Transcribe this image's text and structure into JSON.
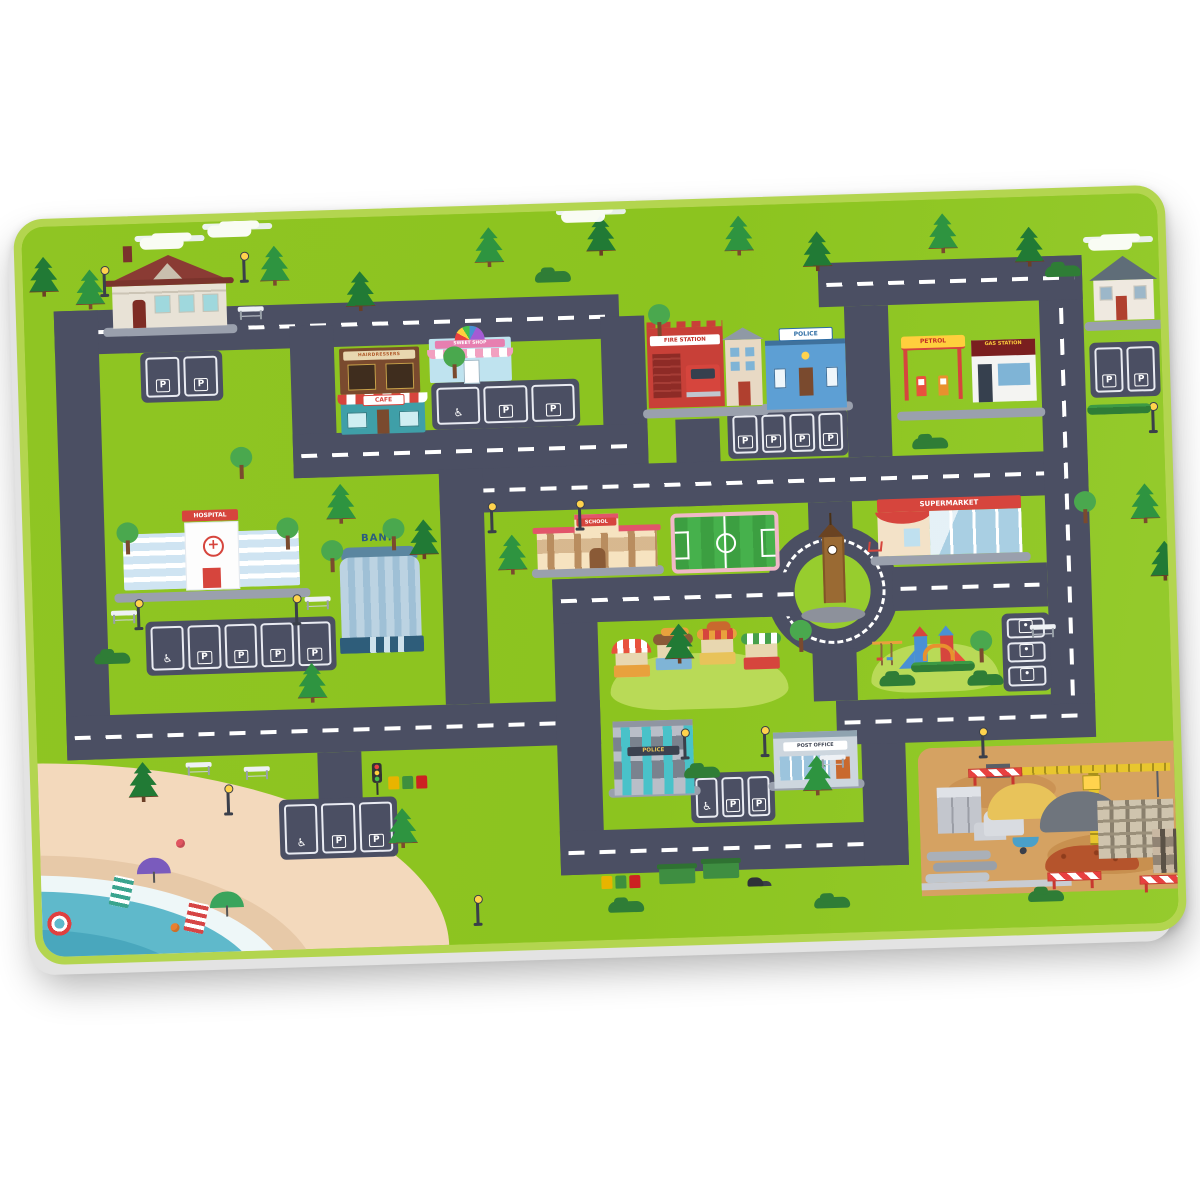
{
  "product": {
    "description": "Kids city road play mat desk pad on white background",
    "background_color": "#ffffff"
  },
  "mat": {
    "base_color": "#8cc41f",
    "rim_color": "#b3d54f",
    "road_color": "#4b4f63",
    "sand_color": "#f3d9bc",
    "water_color": "#5fb9cb",
    "construction_ground_color": "#d5a262",
    "labels": {
      "hospital": "HOSPITAL",
      "bank": "BANK",
      "school": "SCHOOL",
      "fire_station": "FIRE STATION",
      "police_station": "POLICE",
      "police_building": "POLICE",
      "post_office": "POST OFFICE",
      "supermarket": "SUPERMARKET",
      "petrol": "PETROL",
      "gas_station": "GAS STATION",
      "cafe": "CAFE",
      "hairdresser": "HAIRDRESSERS",
      "sweet_shop": "SWEET SHOP",
      "parking_letter": "P"
    },
    "roads": [
      {
        "x": 30,
        "y": 85,
        "w": 565,
        "h": 44,
        "dash": 1
      },
      {
        "x": 30,
        "y": 85,
        "w": 44,
        "h": 449
      },
      {
        "x": 265,
        "y": 107,
        "w": 44,
        "h": 152
      },
      {
        "x": 576,
        "y": 107,
        "w": 44,
        "h": 152
      },
      {
        "x": 265,
        "y": 215,
        "w": 355,
        "h": 44,
        "dash": 1
      },
      {
        "x": 648,
        "y": 212,
        "w": 44,
        "h": 87
      },
      {
        "x": 410,
        "y": 255,
        "w": 649,
        "h": 44,
        "dash": 1
      },
      {
        "x": 410,
        "y": 255,
        "w": 44,
        "h": 235
      },
      {
        "x": 30,
        "y": 490,
        "w": 534,
        "h": 44,
        "dash": 1
      },
      {
        "x": 280,
        "y": 534,
        "w": 44,
        "h": 48
      },
      {
        "x": 520,
        "y": 368,
        "w": 44,
        "h": 296
      },
      {
        "x": 520,
        "y": 368,
        "w": 264,
        "h": 44,
        "dash": 1
      },
      {
        "x": 520,
        "y": 620,
        "w": 348,
        "h": 44,
        "dash": 1
      },
      {
        "x": 824,
        "y": 498,
        "w": 44,
        "h": 166
      },
      {
        "x": 800,
        "y": 498,
        "w": 259,
        "h": 44,
        "dash": 1
      },
      {
        "x": 1015,
        "y": 60,
        "w": 44,
        "h": 448,
        "dash": 1
      },
      {
        "x": 795,
        "y": 60,
        "w": 264,
        "h": 44,
        "dash": 1
      },
      {
        "x": 820,
        "y": 104,
        "w": 44,
        "h": 151
      },
      {
        "x": 860,
        "y": 366,
        "w": 155,
        "h": 44,
        "dash": 1
      },
      {
        "x": 778,
        "y": 299,
        "w": 44,
        "h": 30
      },
      {
        "x": 778,
        "y": 446,
        "w": 44,
        "h": 52
      }
    ],
    "parkings": [
      {
        "x": 115,
        "y": 129,
        "w": 82,
        "h": 50,
        "cells": [
          "P",
          "P"
        ]
      },
      {
        "x": 405,
        "y": 168,
        "w": 148,
        "h": 47,
        "cells": [
          "♿",
          "P",
          "P"
        ]
      },
      {
        "x": 700,
        "y": 205,
        "w": 120,
        "h": 48,
        "cells": [
          "P",
          "P",
          "P",
          "P"
        ]
      },
      {
        "x": 1064,
        "y": 148,
        "w": 70,
        "h": 55,
        "cells": [
          "P",
          "P"
        ]
      },
      {
        "x": 112,
        "y": 398,
        "w": 190,
        "h": 54,
        "cells": [
          "♿",
          "P",
          "P",
          "P",
          "P"
        ]
      },
      {
        "x": 240,
        "y": 580,
        "w": 118,
        "h": 60,
        "cells": [
          "♿",
          "P",
          "P"
        ]
      },
      {
        "x": 652,
        "y": 566,
        "w": 84,
        "h": 50,
        "cells": [
          "♿",
          "P",
          "P"
        ]
      },
      {
        "x": 968,
        "y": 416,
        "w": 48,
        "h": 78,
        "vert": 1,
        "cells": [
          "•",
          "•",
          "•"
        ]
      }
    ],
    "scenery": [
      {
        "t": "pine",
        "x": 237,
        "y": 26
      },
      {
        "t": "pine",
        "x": 322,
        "y": 54,
        "d": 1
      },
      {
        "t": "pine",
        "x": 452,
        "y": 14
      },
      {
        "t": "pine",
        "x": 564,
        "y": 6,
        "d": 1
      },
      {
        "t": "pine",
        "x": 702,
        "y": 10
      },
      {
        "t": "pine",
        "x": 780,
        "y": 28,
        "d": 1
      },
      {
        "t": "pine",
        "x": 906,
        "y": 14
      },
      {
        "t": "pine",
        "x": 992,
        "y": 30,
        "d": 1
      },
      {
        "t": "pine",
        "x": 52,
        "y": 44
      },
      {
        "t": "pine",
        "x": 6,
        "y": 30,
        "d": 1
      },
      {
        "t": "pine",
        "x": 296,
        "y": 266
      },
      {
        "t": "pine",
        "x": 378,
        "y": 304,
        "d": 1
      },
      {
        "t": "pine",
        "x": 466,
        "y": 322
      },
      {
        "t": "pine",
        "x": 1100,
        "y": 290
      },
      {
        "t": "pine",
        "x": 1118,
        "y": 348,
        "d": 1
      },
      {
        "t": "pine",
        "x": 348,
        "y": 592
      },
      {
        "t": "pine",
        "x": 90,
        "y": 538,
        "d": 1
      },
      {
        "t": "pine",
        "x": 764,
        "y": 552
      },
      {
        "t": "pine",
        "x": 630,
        "y": 416,
        "d": 1
      },
      {
        "t": "pine",
        "x": 262,
        "y": 444
      },
      {
        "t": "tree",
        "x": 290,
        "y": 322
      },
      {
        "t": "tree",
        "x": 418,
        "y": 132
      },
      {
        "t": "tree",
        "x": 756,
        "y": 416
      },
      {
        "t": "tree",
        "x": 352,
        "y": 302
      },
      {
        "t": "tree",
        "x": 1044,
        "y": 296
      },
      {
        "t": "tree",
        "x": 624,
        "y": 96
      },
      {
        "t": "tree",
        "x": 202,
        "y": 226
      },
      {
        "t": "tree",
        "x": 86,
        "y": 298
      },
      {
        "t": "tree",
        "x": 246,
        "y": 298
      },
      {
        "t": "bush",
        "x": 512,
        "y": 60
      },
      {
        "t": "bush",
        "x": 884,
        "y": 238
      },
      {
        "t": "bush",
        "x": 646,
        "y": 560
      },
      {
        "t": "bush",
        "x": 1022,
        "y": 70
      },
      {
        "t": "bush",
        "x": 566,
        "y": 692
      },
      {
        "t": "bush",
        "x": 772,
        "y": 694
      },
      {
        "t": "bush",
        "x": 986,
        "y": 694
      },
      {
        "t": "bush",
        "x": 60,
        "y": 428
      },
      {
        "t": "cloud",
        "x": 118,
        "y": 14
      },
      {
        "t": "cloud",
        "x": 186,
        "y": 4
      },
      {
        "t": "cloud",
        "x": 1066,
        "y": 44
      },
      {
        "t": "cloud",
        "x": 540,
        "y": 0
      },
      {
        "t": "lamp",
        "x": 80,
        "y": 46
      },
      {
        "t": "lamp",
        "x": 220,
        "y": 36
      },
      {
        "t": "lamp",
        "x": 460,
        "y": 294
      },
      {
        "t": "lamp",
        "x": 548,
        "y": 294
      },
      {
        "t": "lamp",
        "x": 646,
        "y": 526
      },
      {
        "t": "lamp",
        "x": 726,
        "y": 526
      },
      {
        "t": "lamp",
        "x": 944,
        "y": 534
      },
      {
        "t": "lamp",
        "x": 434,
        "y": 686
      },
      {
        "t": "lamp",
        "x": 104,
        "y": 380
      },
      {
        "t": "lamp",
        "x": 262,
        "y": 380
      },
      {
        "t": "lamp",
        "x": 188,
        "y": 568
      },
      {
        "t": "lamp",
        "x": 1124,
        "y": 214
      },
      {
        "t": "bench",
        "x": 214,
        "y": 86
      },
      {
        "t": "bench",
        "x": 996,
        "y": 428
      },
      {
        "t": "bench",
        "x": 782,
        "y": 552
      },
      {
        "t": "bench",
        "x": 148,
        "y": 540
      },
      {
        "t": "bench",
        "x": 206,
        "y": 546
      },
      {
        "t": "bench",
        "x": 78,
        "y": 386
      },
      {
        "t": "bench",
        "x": 272,
        "y": 378
      },
      {
        "t": "hedge",
        "x": 1060,
        "y": 210
      },
      {
        "t": "hedge",
        "x": 876,
        "y": 462
      },
      {
        "t": "tlight",
        "x": 334,
        "y": 546
      },
      {
        "t": "bins",
        "x": 350,
        "y": 560
      },
      {
        "t": "bins",
        "x": 560,
        "y": 666
      },
      {
        "t": "dumpster",
        "x": 618,
        "y": 660
      },
      {
        "t": "dumpster",
        "x": 662,
        "y": 656
      },
      {
        "t": "trash",
        "x": 706,
        "y": 672
      },
      {
        "t": "umbrella",
        "x": 96,
        "y": 634,
        "c": "#7a5bbd"
      },
      {
        "t": "umbrella",
        "x": 168,
        "y": 670,
        "c": "#3aa45c"
      },
      {
        "t": "towel",
        "x": 70,
        "y": 652,
        "c": "#3aa48e"
      },
      {
        "t": "towel",
        "x": 144,
        "y": 680,
        "c": "#d64545"
      },
      {
        "t": "buoy",
        "x": 4,
        "y": 684
      },
      {
        "t": "ball",
        "x": 136,
        "y": 616
      },
      {
        "t": "ball",
        "x": 128,
        "y": 700,
        "c": "#e88030"
      }
    ]
  }
}
